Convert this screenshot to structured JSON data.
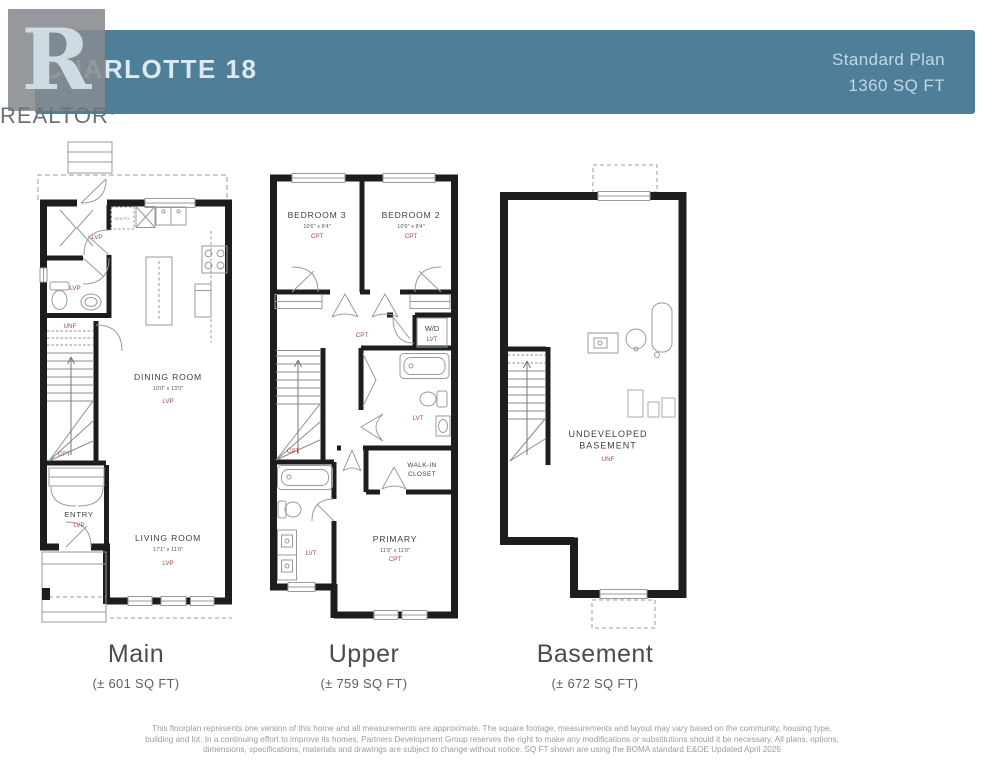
{
  "header": {
    "plan_name": "CHARLOTTE 18",
    "plan_type": "Standard Plan",
    "total_sqft": "1360 SQ FT",
    "banner_color": "#4e7e98"
  },
  "logo": {
    "letter": "R",
    "name": "REALTOR",
    "reg": "®"
  },
  "floors": {
    "main": {
      "name": "Main",
      "sqft": "(± 601 SQ FT)"
    },
    "upper": {
      "name": "Upper",
      "sqft": "(± 759 SQ FT)"
    },
    "basement": {
      "name": "Basement",
      "sqft": "(± 672 SQ FT)"
    }
  },
  "labels": {
    "main": {
      "pantry": "PANTRY",
      "mudroom_mat": "LVP",
      "bath_mat": "LVP",
      "stair_mat_top": "UNF",
      "stair_mat_bottom": "CPT",
      "dining": {
        "name": "DINING ROOM",
        "dims": "10'0\" x 13'0\"",
        "mat": "LVP"
      },
      "entry": {
        "name": "ENTRY",
        "mat": "LVP"
      },
      "living": {
        "name": "LIVING ROOM",
        "dims": "17'1\" x 11'0\"",
        "mat": "LVP"
      }
    },
    "upper": {
      "bedroom3": {
        "name": "BEDROOM 3",
        "dims": "10'6\" x 8'4\"",
        "mat": "CPT"
      },
      "bedroom2": {
        "name": "BEDROOM 2",
        "dims": "10'6\" x 8'4\"",
        "mat": "CPT"
      },
      "hall_mat": "CPT",
      "wd": {
        "name": "W/D",
        "mat": "LVT"
      },
      "bath_mat": "LVT",
      "stair_mat": "CPT",
      "wic_line1": "WALK-IN",
      "wic_line2": "CLOSET",
      "ensuite_mat": "LVT",
      "primary": {
        "name": "PRIMARY",
        "dims": "11'9\" x 11'0\"",
        "mat": "CPT"
      }
    },
    "basement": {
      "name_line1": "UNDEVELOPED",
      "name_line2": "BASEMENT",
      "mat": "UNF"
    }
  },
  "disclaimer": "This floorplan represents one version of this home and all measurements are approximate. The square footage, measurements and layout may vary based on the community, housing type, building and lot. In a continuing effort to improve its homes, Partners Development Group reserves the right to make any modifications or substitutions should it be necessary. All plans, options, dimensions, specifications, materials and drawings are subject to change without notice. SQ FT shown are using the BOMA standard E&OE Updated April 2025"
}
